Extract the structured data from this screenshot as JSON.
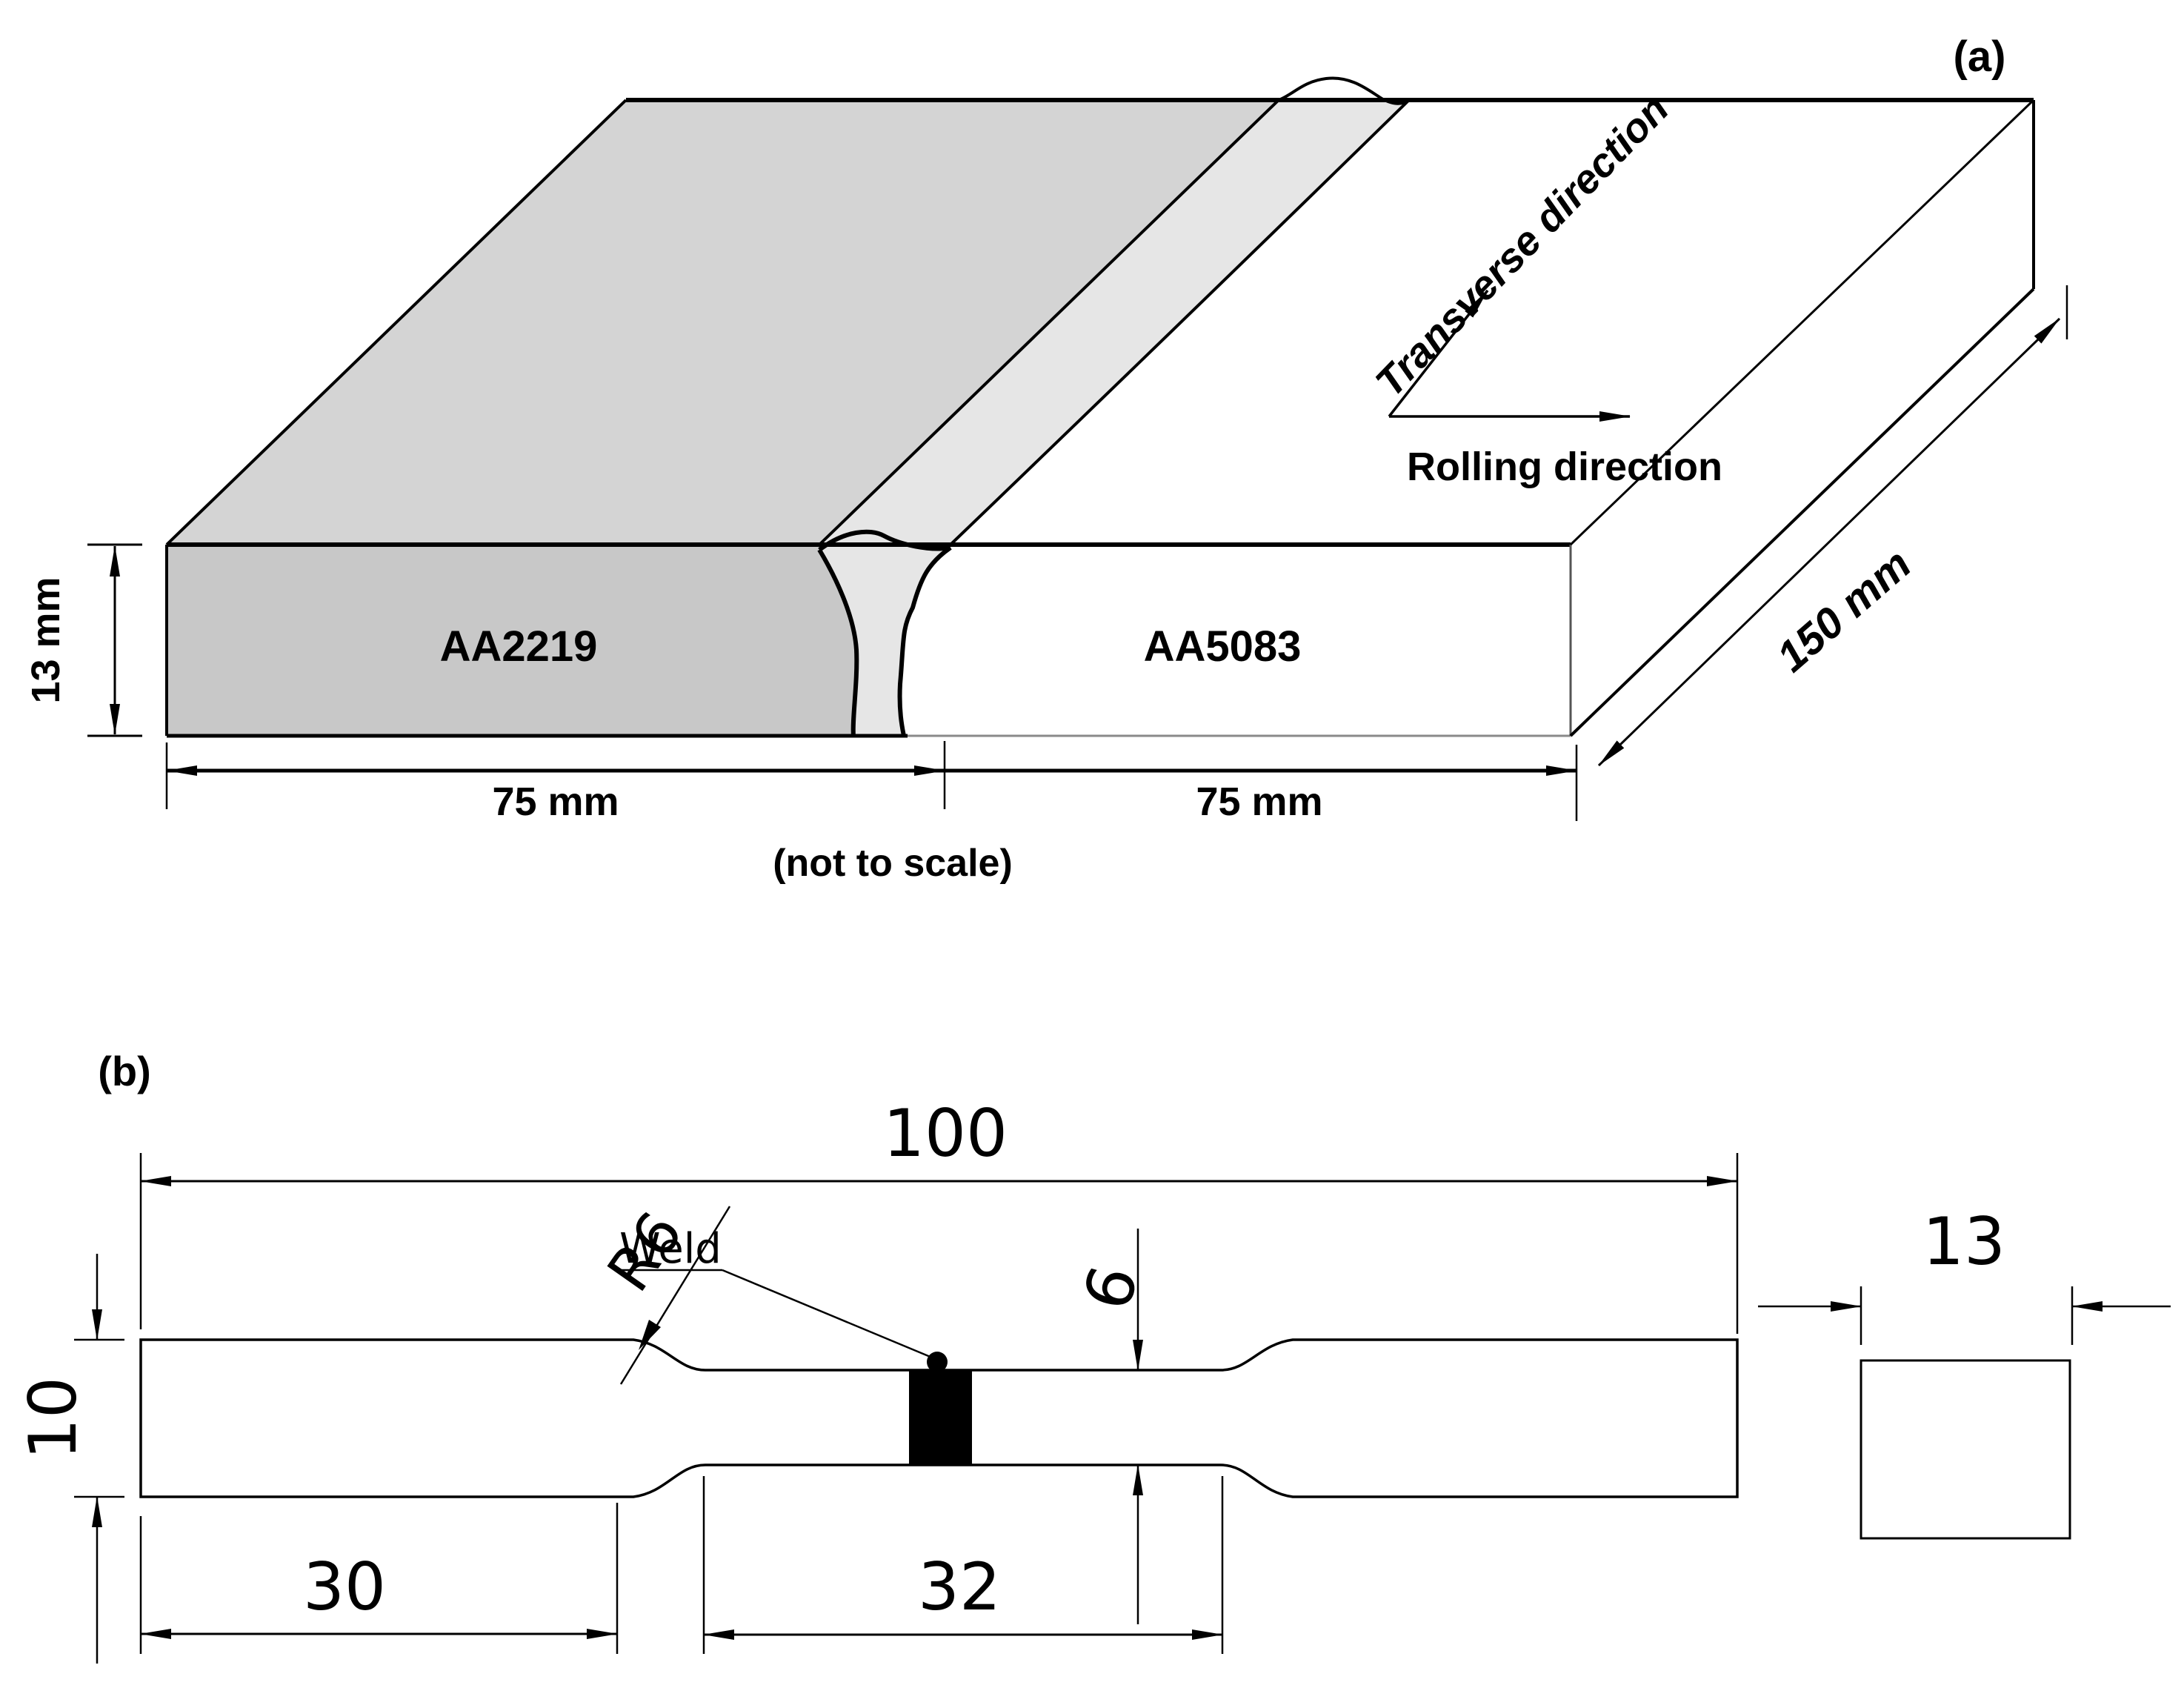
{
  "colors": {
    "line": "#000000",
    "soft_line": "#777777",
    "aa2219_top": "#d4d4d4",
    "aa2219_front": "#c8c8c8",
    "weld": "#e6e6e6",
    "aa5083": "#ffffff",
    "weld_mark": "#000000"
  },
  "panel_a": {
    "label": "(a)",
    "material_left": "AA2219",
    "material_right": "AA5083",
    "transverse_label": "Transverse direction",
    "rolling_label": "Rolling direction",
    "dim_length": "150 mm",
    "dim_thickness": "13 mm",
    "dim_width_left": "75 mm",
    "dim_width_right": "75 mm",
    "note": "(not to scale)"
  },
  "panel_b": {
    "label": "(b)",
    "dim_total_length": "100",
    "fillet_radius": "R6",
    "weld_label": "Weld",
    "dim_gauge_width": "6",
    "dim_grip_length": "30",
    "dim_gauge_length": "32",
    "dim_grip_width": "10",
    "dim_thickness": "13"
  }
}
